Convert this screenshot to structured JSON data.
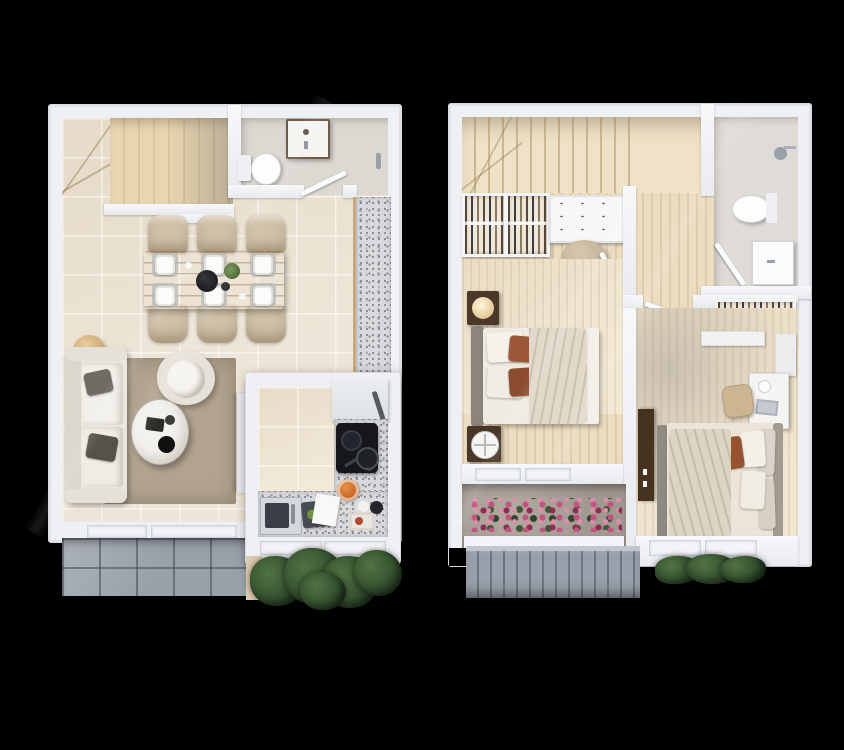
{
  "scene": {
    "background_color": "#000000",
    "view": "top-down-3d-floor-plans",
    "plans_count": 2
  },
  "palette": {
    "wall": "#eff0f3",
    "floor_tile": "#eee6d8",
    "wood_floor": "#ecdcc0",
    "stair_wood": "#e9d6b1",
    "granite_counter": "#d8d9db",
    "patio_tile": "#99a0a9",
    "railing_gray": "#8e95a0",
    "rug": "#b2a390",
    "sofa": "#e9e6df",
    "dining_table_wood": "#b5835a",
    "chair_beige": "#cfc0a6",
    "bed_linen": "#efe9df",
    "accent_pillow_rust": "#9a5637",
    "cooktop_black": "#17181c",
    "flower_pink": "#c2557f",
    "flower_magenta": "#8e2c52",
    "foliage_green": "#3d5a35",
    "shrub_green": "#35512f",
    "nightstand_wood": "#4b3828",
    "wardrobe_dark": "#453320"
  },
  "floors": {
    "ground": {
      "name": "ground-floor-plan",
      "rooms": [
        "staircase",
        "guest-bathroom",
        "dining-area",
        "living-room",
        "kitchen",
        "patio"
      ],
      "furniture": [
        "l-shaped-stairs",
        "toilet",
        "vanity-sink",
        "towel-bar",
        "dining-table",
        "dining-chairs",
        "dinner-plates",
        "serving-bowl",
        "table-plant",
        "sofa",
        "throw-pillows",
        "round-side-tables",
        "armchair",
        "coffee-table",
        "area-rug",
        "tv-panel",
        "granite-counter",
        "cooktop",
        "frying-pan",
        "refrigerator",
        "kitchen-sink",
        "cutting-board",
        "fruit-bowl",
        "window-sills",
        "patio-tiles",
        "shrubs"
      ]
    },
    "upper": {
      "name": "upper-floor-plan",
      "rooms": [
        "staircase",
        "hallway",
        "bathroom",
        "bedroom-1",
        "walk-in-closet",
        "bedroom-2",
        "balcony"
      ],
      "furniture": [
        "stairs",
        "wardrobe-closet",
        "dressing-table",
        "pouf",
        "shower-head",
        "toilet",
        "sink-cabinet",
        "second-closet",
        "double-bed-1",
        "nightstand-with-lamp",
        "nightstand-with-mirror",
        "double-bed-2",
        "desk",
        "desk-chair",
        "tall-dark-wardrobe",
        "wall-shelf",
        "flower-planter",
        "balcony-railing",
        "window-sills",
        "shrubs"
      ]
    }
  },
  "counts": {
    "dining_chairs": 6,
    "dinner_plates": 6,
    "bedrooms": 2,
    "bathrooms": 2,
    "doors_visible": 5
  }
}
